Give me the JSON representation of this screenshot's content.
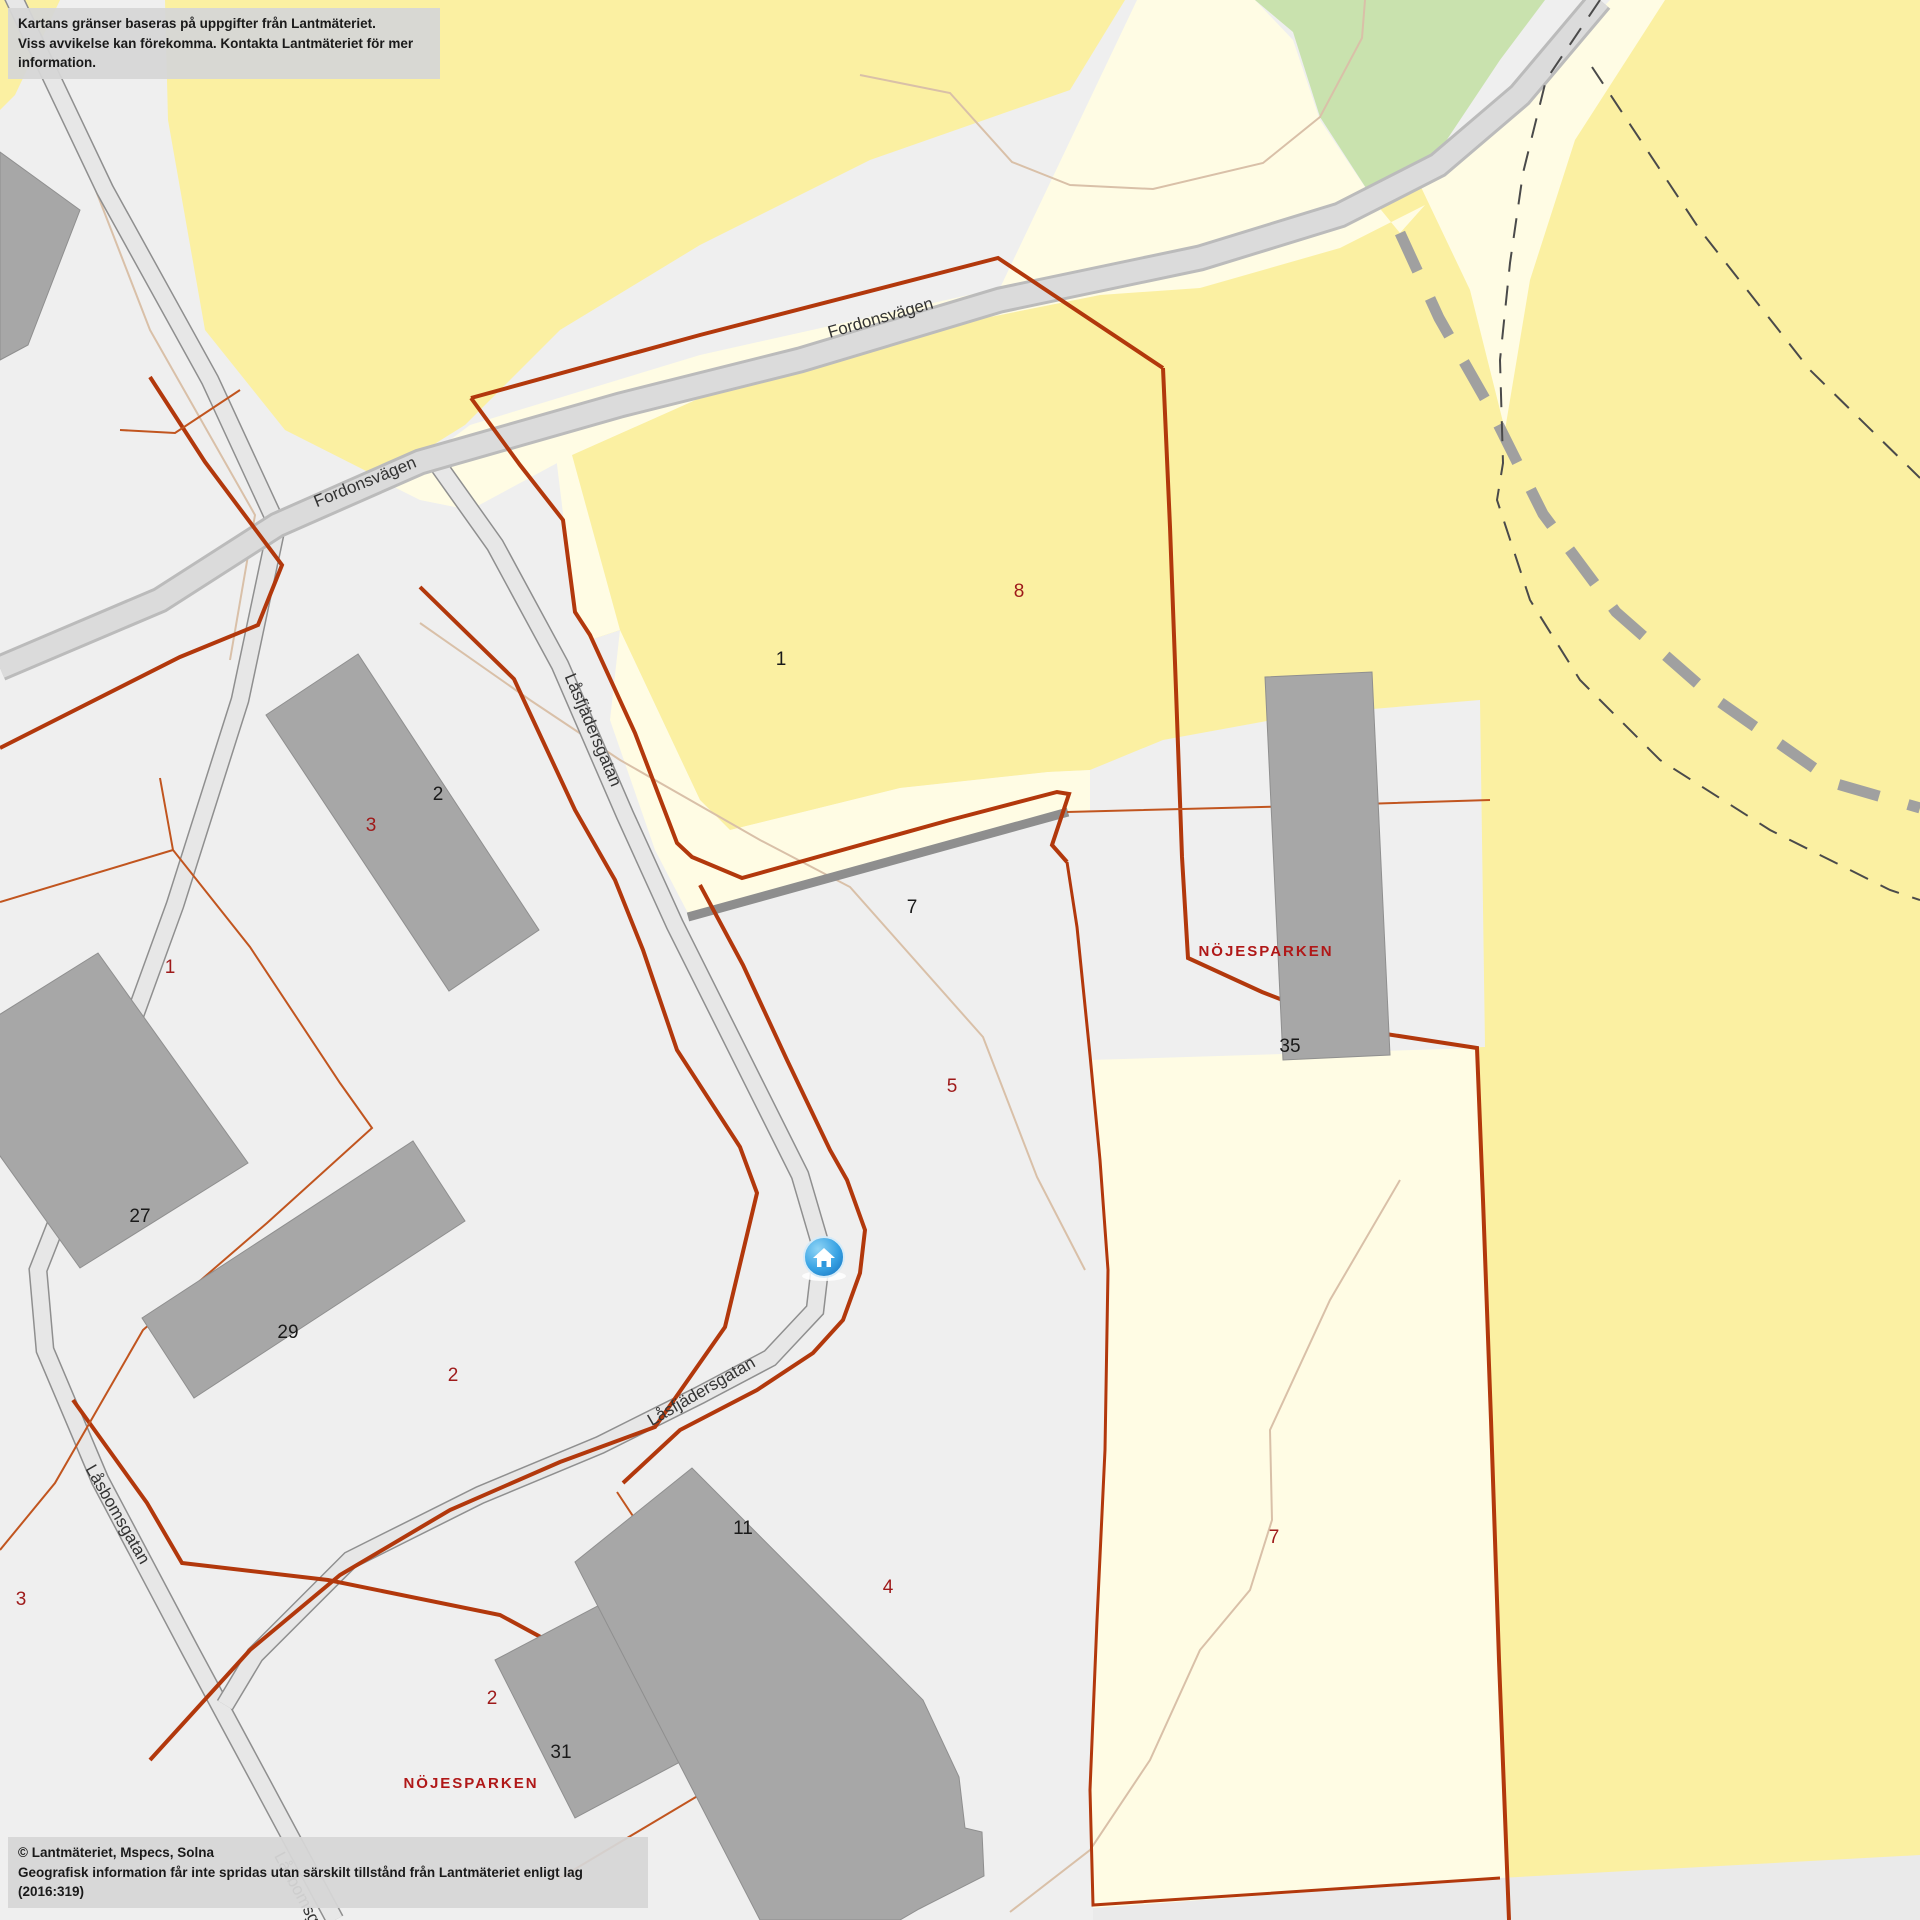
{
  "disclaimer": {
    "line1": "Kartans gränser baseras på uppgifter från Lantmäteriet.",
    "line2": "Viss avvikelse kan förekomma. Kontakta Lantmäteriet för mer information."
  },
  "attribution": {
    "line1": "© Lantmäteriet, Mspecs, Solna",
    "line2": "Geografisk information får inte spridas utan särskilt tillstånd från Lantmäteriet enligt lag (2016:319)"
  },
  "streets": {
    "fordonsvagen": "Fordonsvägen",
    "lasfjadersgatan": "Låsfjädersgatan",
    "lasbomsgatan": "Låsbomsgatan"
  },
  "areas": {
    "park1": "NÖJESPARKEN",
    "park2": "NÖJESPARKEN"
  },
  "parcel_numbers_black": {
    "n1": "1",
    "n2": "2",
    "n7": "7",
    "n27": "27",
    "n29": "29",
    "n35": "35",
    "n11": "11",
    "n31": "31"
  },
  "parcel_numbers_red": {
    "r8": "8",
    "r3a": "3",
    "r1": "1",
    "r2a": "2",
    "r3b": "3",
    "r5": "5",
    "r2b": "2",
    "r7": "7",
    "r4": "4"
  },
  "marker": {
    "icon": "home-icon"
  },
  "colors": {
    "urban_ground": "#EFEFEF",
    "land_yellow": "#FBF0A2",
    "land_cream": "#FFFCE4",
    "land_green": "#C9E2AE",
    "building": "#A7A7A7",
    "boundary_red": "#B2380C",
    "boundary_orange": "#C1551F",
    "path_tan": "#D9C0A8",
    "road_fill": "#E7E7E7",
    "main_road_fill": "#DBDBDB",
    "marker_blue": "#2D96DC",
    "label_red": "#B01818"
  }
}
